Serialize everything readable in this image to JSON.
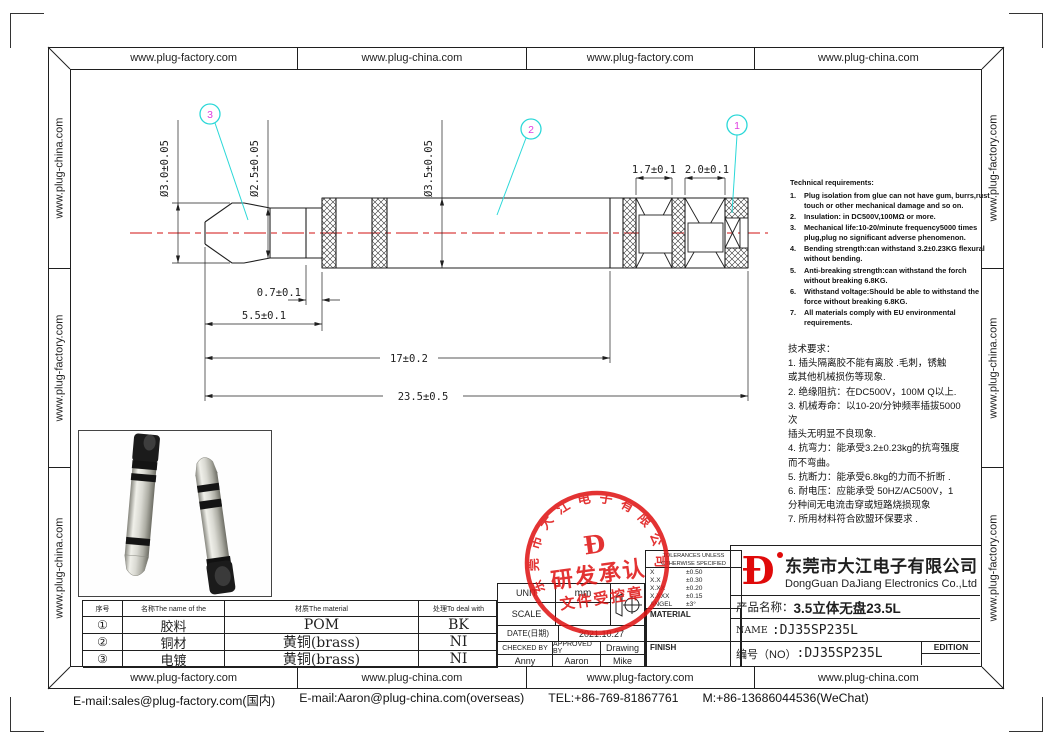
{
  "border": {
    "top": [
      "www.plug-factory.com",
      "www.plug-china.com",
      "www.plug-factory.com",
      "www.plug-china.com"
    ],
    "bottom": [
      "www.plug-factory.com",
      "www.plug-china.com",
      "www.plug-factory.com",
      "www.plug-china.com"
    ],
    "left": [
      "www.plug-china.com",
      "www.plug-factory.com",
      "www.plug-china.com"
    ],
    "right": [
      "www.plug-factory.com",
      "www.plug-china.com",
      "www.plug-factory.com"
    ]
  },
  "footer": {
    "email_domestic": "E-mail:sales@plug-factory.com(国内)",
    "email_overseas": "E-mail:Aaron@plug-china.com(overseas)",
    "tel": "TEL:+86-769-81867761",
    "mobile": "M:+86-13686044536(WeChat)"
  },
  "drawing": {
    "dims": {
      "dia30": "Ø3.0±0.05",
      "dia25": "Ø2.5±0.05",
      "dia35": "Ø3.5±0.05",
      "len17": "1.7±0.1",
      "len20": "2.0±0.1",
      "len07": "0.7±0.1",
      "len55": "5.5±0.1",
      "len170": "17±0.2",
      "len235": "23.5±0.5"
    },
    "balloons": [
      "1",
      "2",
      "3"
    ],
    "colors": {
      "centerline": "#e06060",
      "balloon_circle": "#2bd8d8",
      "balloon_number": "#e03ee0",
      "stamp_red": "#e01515",
      "logo_red": "#e00a0a"
    }
  },
  "tech_req_en": {
    "title": "Technical requirements:",
    "items": [
      {
        "num": "1.",
        "text": "Plug isolation from glue can not have gum, burrs,rust touch or other mechanical damage and so on."
      },
      {
        "num": "2.",
        "text": "Insulation: in DC500V,100MΩ or more."
      },
      {
        "num": "3.",
        "text": "Mechanical life:10-20/minute frequency5000 times plug,plug no significant adverse phenomenon."
      },
      {
        "num": "4.",
        "text": "Bending strength:can withstand 3.2±0.23KG flexural without bending."
      },
      {
        "num": "5.",
        "text": "Anti-breaking strength:can withstand the forch without breaking 6.8KG."
      },
      {
        "num": "6.",
        "text": "Withstand voltage:Should be able to withstand the force without breaking 6.8KG."
      },
      {
        "num": "7.",
        "text": "All materials comply with EU environmental requirements."
      }
    ]
  },
  "tech_req_cn": {
    "lines": [
      "技术要求：",
      "1. 插头隔离胶不能有离胶 .毛刺，锈触",
      "或其他机械损伤等现象.",
      "2. 绝缘阻抗：在DC500V，100M Q以上.",
      "3. 机械寿命：以10-20/分钟频率插拔5000",
      "次",
      "插头无明显不良现象.",
      "4. 抗弯力：能承受3.2±0.23kg的抗弯强度",
      "而不弯曲。",
      "5. 抗断力：能承受6.8kg的力而不折断 .",
      "6. 耐电压：应能承受 50HZ/AC500V，1",
      "分种间无电流击穿或短路烧损现象",
      "7. 所用材料符合欧盟环保要求 ."
    ]
  },
  "materials_table": {
    "headers": [
      "序号",
      "名称The name of the",
      "材质The material",
      "处理To deal with"
    ],
    "rows": [
      {
        "no": "①",
        "name": "胶料",
        "material": "POM",
        "treat": "BK"
      },
      {
        "no": "②",
        "name": "铜材",
        "material": "黄铜(brass)",
        "treat": "NI"
      },
      {
        "no": "③",
        "name": "电镀",
        "material": "黄铜(brass)",
        "treat": "NI"
      }
    ]
  },
  "spec": {
    "unit_label": "UNIT",
    "unit_value": "mm",
    "scale_label": "SCALE",
    "projection_symbol": "third-angle-projection",
    "date_label": "DATE(日期)",
    "date_value": "2021.10.27",
    "checked_label": "CHECKED BY",
    "approved_label": "APPROVED BY",
    "drawing_label": "Drawing",
    "checked_by": "Anny",
    "approved_by": "Aaron",
    "drawn_by": "Mike"
  },
  "tolerances": {
    "header_line1": "TOLERANCES UNLESS",
    "header_line2": "OTHERWISE SPECIFIED",
    "rows": [
      {
        "k": "X",
        "v": "±0.50"
      },
      {
        "k": "X.X",
        "v": "±0.30"
      },
      {
        "k": "X.XX",
        "v": "±0.20"
      },
      {
        "k": "X.XXX",
        "v": "±0.15"
      },
      {
        "k": "ANGEL",
        "v": "±3°"
      }
    ],
    "material_label": "MATERIAL",
    "finish_label": "FINISH"
  },
  "title_block": {
    "logo_glyph": "Ð",
    "company_cn": "东莞市大江电子有限公司",
    "company_en": "DongGuan DaJiang Electronics Co.,Ltd",
    "product_label": "产品名称：",
    "product_value": "3.5立体无盘23.5L",
    "name_label": "NAME",
    "name_value": ":DJ35SP235L",
    "no_label": "编号（NO）",
    "no_value": ":DJ35SP235L",
    "edition_label": "EDITION"
  },
  "stamp": {
    "ring_text": "东莞市大江电子有限公司",
    "logo_glyph": "Ð",
    "line1": "研发承认",
    "line2": "文件受控章"
  }
}
